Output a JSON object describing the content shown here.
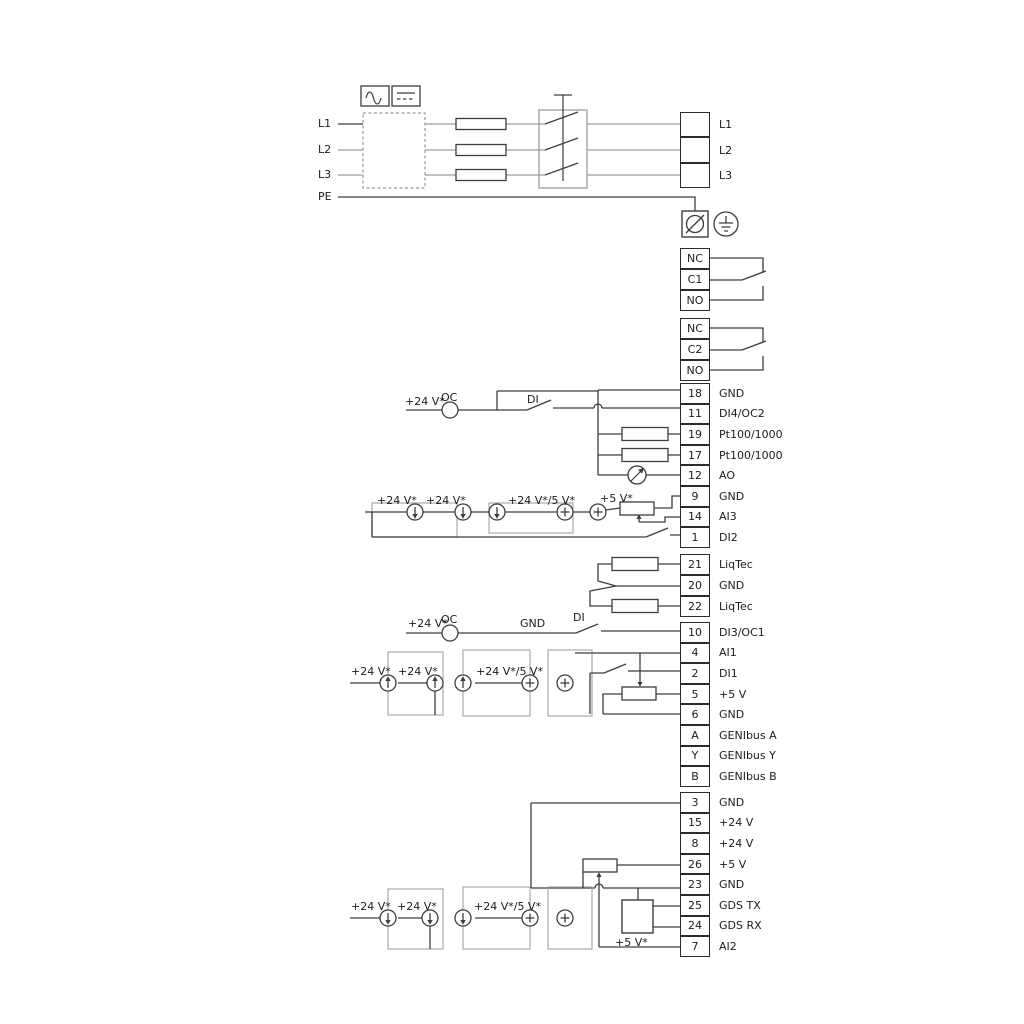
{
  "power": {
    "inputs": [
      "L1",
      "L2",
      "L3",
      "PE"
    ],
    "outputs": [
      "L1",
      "L2",
      "L3"
    ]
  },
  "relays": {
    "relay1": [
      "NC",
      "C1",
      "NO"
    ],
    "relay2": [
      "NC",
      "C2",
      "NO"
    ]
  },
  "strips": {
    "upper": [
      {
        "num": "18",
        "label": "GND"
      },
      {
        "num": "11",
        "label": "DI4/OC2"
      },
      {
        "num": "19",
        "label": "Pt100/1000"
      },
      {
        "num": "17",
        "label": "Pt100/1000"
      },
      {
        "num": "12",
        "label": "AO"
      },
      {
        "num": "9",
        "label": "GND"
      },
      {
        "num": "14",
        "label": "AI3"
      },
      {
        "num": "1",
        "label": "DI2"
      }
    ],
    "liqtec": [
      {
        "num": "21",
        "label": "LiqTec"
      },
      {
        "num": "20",
        "label": "GND"
      },
      {
        "num": "22",
        "label": "LiqTec"
      }
    ],
    "middle": [
      {
        "num": "10",
        "label": "DI3/OC1"
      },
      {
        "num": "4",
        "label": "AI1"
      },
      {
        "num": "2",
        "label": "DI1"
      },
      {
        "num": "5",
        "label": "+5 V"
      },
      {
        "num": "6",
        "label": "GND"
      },
      {
        "num": "A",
        "label": "GENIbus A"
      },
      {
        "num": "Y",
        "label": "GENIbus Y"
      },
      {
        "num": "B",
        "label": "GENIbus B"
      }
    ],
    "lower": [
      {
        "num": "3",
        "label": "GND"
      },
      {
        "num": "15",
        "label": "+24 V"
      },
      {
        "num": "8",
        "label": "+24 V"
      },
      {
        "num": "26",
        "label": "+5 V"
      },
      {
        "num": "23",
        "label": "GND"
      },
      {
        "num": "25",
        "label": "GDS TX"
      },
      {
        "num": "24",
        "label": "GDS RX"
      },
      {
        "num": "7",
        "label": "AI2"
      }
    ]
  },
  "annotations": {
    "di4_row": {
      "supply": "+24 V*",
      "oc": "OC",
      "di": "DI"
    },
    "ai3_row": {
      "s1": "+24 V*",
      "s2": "+24 V*",
      "s3": "+24 V*/5 V*",
      "s4": "+5 V*"
    },
    "di3_row": {
      "supply": "+24 V*",
      "oc": "OC",
      "gnd": "GND",
      "di": "DI"
    },
    "ai1_row": {
      "s1": "+24 V*",
      "s2": "+24 V*",
      "s3": "+24 V*/5 V*"
    },
    "ai2_row": {
      "s1": "+24 V*",
      "s2": "+24 V*",
      "s3": "+24 V*/5 V*",
      "s4": "+5 V*"
    }
  },
  "icons": {
    "rcd_ac": "sine-wave",
    "rcd_dc": "line-over-dashes",
    "emc_filter": "dashed-box",
    "fuse": "rectangle",
    "disconnect_switch": "triple-blade-switch",
    "pe_terminal": "circle-slash",
    "earth_ground": "ground-in-circle",
    "pt_sensor": "resistor-rect",
    "ao_meter": "dial-arrow-circle",
    "current_source": "circle-arrow",
    "voltage_source": "circle-plus",
    "potentiometer": "rect-with-wiper",
    "gds_sensor": "square-box"
  },
  "colors": {
    "wire_dark": "#3d3d3d",
    "wire_gray": "#9e9e9e",
    "text": "#1c1c1c",
    "background": "#ffffff"
  }
}
